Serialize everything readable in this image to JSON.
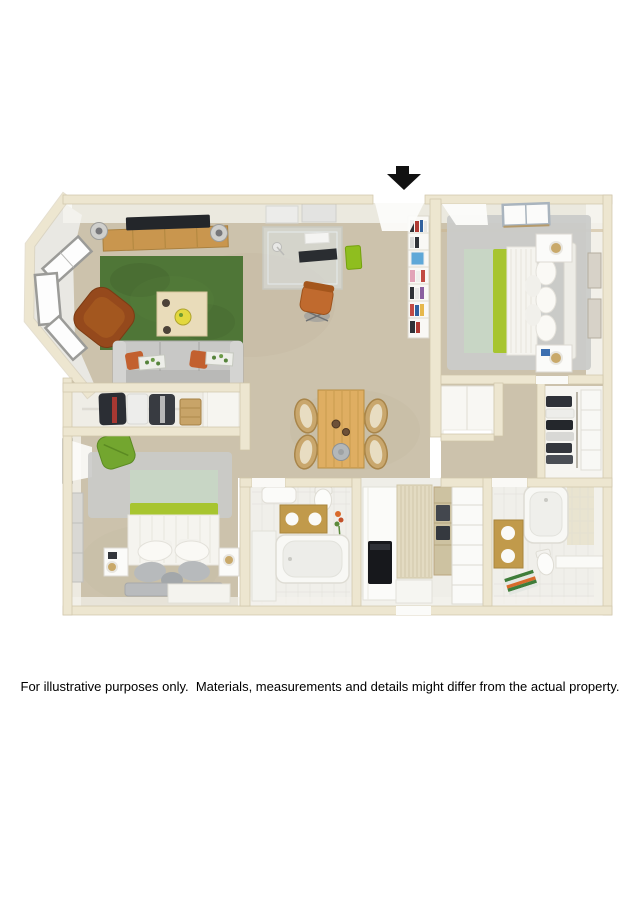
{
  "disclaimer": {
    "text": "For illustrative purposes only.  Materials, measurements and details might differ from the actual property."
  },
  "entrance_arrow": {
    "label": "entrance",
    "direction": "down"
  },
  "palette": {
    "background": "#FFFFFF",
    "text": "#000000",
    "arrow": "#111111",
    "wall": "#EDE6D0",
    "wall_edge": "#CFC5A9",
    "wall_face": "#F6F5F0",
    "carpet": "#CCC2AC",
    "carpet_shade": "#BDB29A",
    "tile": "#F0EFEA",
    "tile_line": "#DCDBD3",
    "white_obj": "#FBFBF9",
    "rug_green": "#4F7637",
    "rug_green_dark": "#3F5E2B",
    "rug_silver": "#CACBC9",
    "sofa_gray": "#C8C8C6",
    "sofa_back": "#B9B9B7",
    "pillow_orange": "#C2602F",
    "armchair_brown": "#95491C",
    "office_chair": "#C06A2E",
    "wood": "#C9964E",
    "wood_pale": "#E9DCBA",
    "table_wood": "#DFAE62",
    "rattan": "#C9A76D",
    "bed_sage": "#C8D6C5",
    "bed_lime": "#A7C52F",
    "bed_white": "#F5F4EF",
    "pillow_gray": "#B7BABC",
    "headboard_gray": "#B9BBBD",
    "chair_green": "#73A62F",
    "vanity_gold": "#C19A4B",
    "appliance_black": "#17181C",
    "towel_dark": "#43474E",
    "louver": "#E3DBC2",
    "glass": "#DCE4E6",
    "tv_black": "#23262A"
  }
}
